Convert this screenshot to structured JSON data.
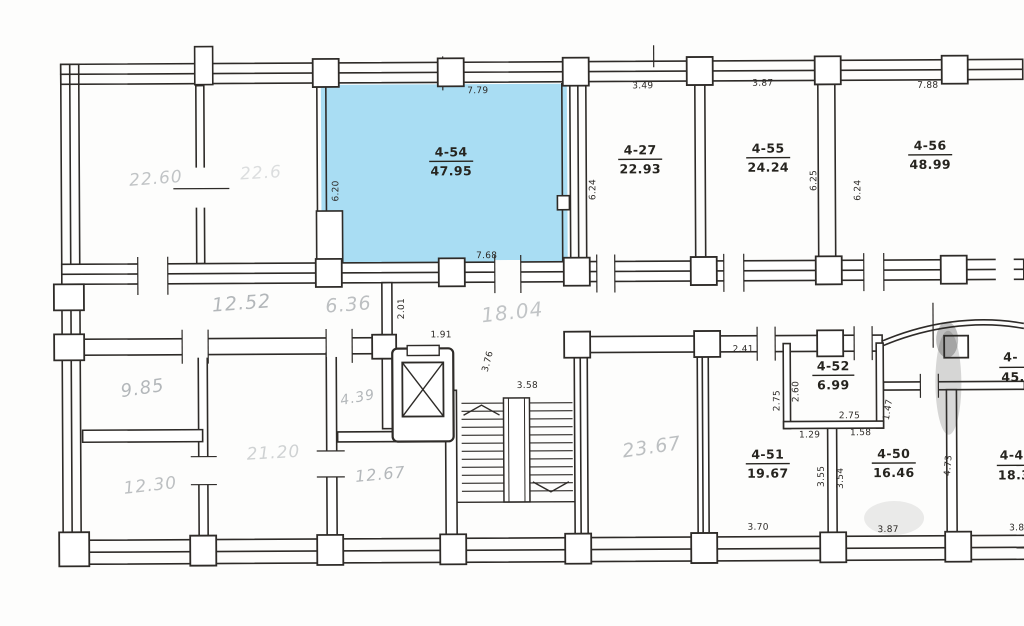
{
  "plan": {
    "colors": {
      "highlight": "#a9ddf3",
      "ink": "#2e2b28",
      "pencil": "#878d92",
      "paper": "#fdfdfc"
    },
    "highlighted_room": {
      "id": "4-54",
      "area": "47.95"
    },
    "ink_rooms": [
      {
        "id": "4-27",
        "area": "22.93"
      },
      {
        "id": "4-55",
        "area": "24.24"
      },
      {
        "id": "4-56",
        "area": "48.99"
      },
      {
        "id": "4-52",
        "area": "6.99"
      },
      {
        "id": "4-51",
        "area": "19.67"
      },
      {
        "id": "4-50",
        "area": "16.46"
      },
      {
        "id": "4-",
        "area": "45."
      },
      {
        "id": "4-4",
        "area": "18.3"
      }
    ],
    "pencil": [
      "22.60",
      "22.6",
      "12.52",
      "6.36",
      "18.04",
      "9.85",
      "12.30",
      "21.20",
      "4.39",
      "12.67",
      "23.67"
    ],
    "dims": [
      "7.79",
      "6.20",
      "7.68",
      "3.49",
      "6.24",
      "3.87",
      "6.25",
      "7.88",
      "6.24",
      "2.01",
      "1.91",
      "3.76",
      "3.58",
      "2.41",
      "2.75",
      "2.60",
      "2.75",
      "1.29",
      "1.58",
      "1.47",
      "3.55",
      "3.54",
      "4.73",
      "3.70",
      "3.87",
      "3.8"
    ]
  }
}
